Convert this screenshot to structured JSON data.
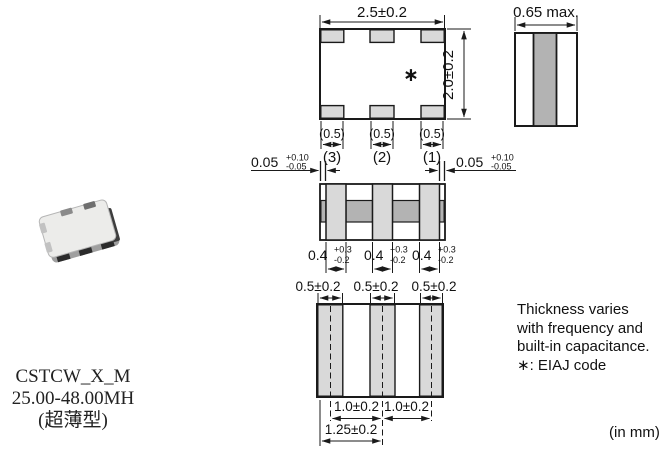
{
  "part": {
    "name": "CSTCW_X_M",
    "freq_range": "25.00-48.00MH",
    "type_note": "(超薄型)"
  },
  "top_view": {
    "width_dim": "2.5±0.2",
    "height_dim": "2.0±0.2",
    "pad_width_dim": "(0.5)",
    "pin_labels": [
      "(3)",
      "(2)",
      "(1)"
    ],
    "eiaj_mark": "∗"
  },
  "side_view": {
    "thickness_dim": "0.65 max."
  },
  "front_view": {
    "edge_gap_dim": "0.05",
    "edge_gap_tol_plus": "+0.10",
    "edge_gap_tol_minus": "-0.05",
    "terminal_width_dim": "0.4",
    "terminal_tol_plus": "+0.3",
    "terminal_tol_minus": "-0.2"
  },
  "bottom_view": {
    "land_width_dim": "0.5±0.2",
    "pitch_dim": "1.0±0.2",
    "edge_to_center_dim": "1.25±0.2"
  },
  "notes": {
    "line1": "Thickness varies",
    "line2": "with frequency and",
    "line3": "built-in capacitance.",
    "line4": "∗: EIAJ code"
  },
  "footer": {
    "units": "(in mm)"
  },
  "colors": {
    "bg": "#ffffff",
    "line": "#1a1a1a",
    "gray_light": "#d9d9d9",
    "gray_mid": "#b3b3b3"
  }
}
